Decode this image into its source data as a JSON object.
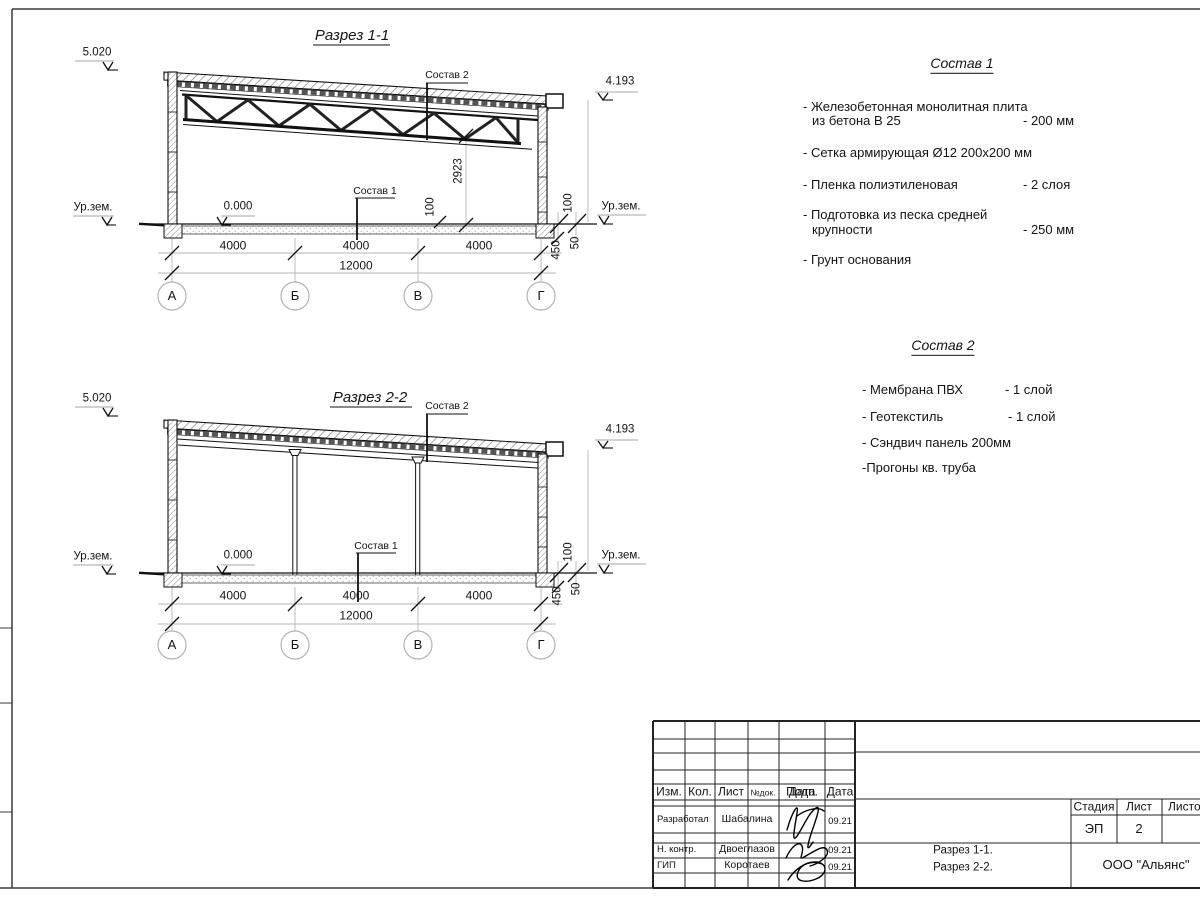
{
  "section1": {
    "title": "Разрез 1-1",
    "elevation_top": "5.020",
    "elevation_roof": "4.193",
    "ground_left": "Ур.зем.",
    "ground_right": "Ур.зем.",
    "floor_level": "0.000",
    "ref_sostav1": "Состав 1",
    "ref_sostav2": "Состав 2",
    "dim_truss_height": "2923",
    "dim_slab": "100",
    "dim_wall": "100",
    "dim_foundation": "450",
    "dim_bed": "50",
    "span_dims": [
      "4000",
      "4000",
      "4000"
    ],
    "total_dim": "12000",
    "axes": [
      "А",
      "Б",
      "В",
      "Г"
    ]
  },
  "section2": {
    "title": "Разрез 2-2",
    "elevation_top": "5.020",
    "elevation_roof": "4.193",
    "ground_left": "Ур.зем.",
    "ground_right": "Ур.зем.",
    "floor_level": "0.000",
    "ref_sostav1": "Состав 1",
    "ref_sostav2": "Состав 2",
    "dim_wall": "100",
    "dim_foundation": "450",
    "dim_bed": "50",
    "span_dims": [
      "4000",
      "4000",
      "4000"
    ],
    "total_dim": "12000",
    "axes": [
      "А",
      "Б",
      "В",
      "Г"
    ]
  },
  "notes1": {
    "heading": "Состав 1",
    "item1_line1": "- Железобетонная  монолитная плита",
    "item1_line2": "из бетона В 25",
    "item1_value": "- 200 мм",
    "item2": "- Сетка армирующая Ø12 200х200 мм",
    "item3": "- Пленка полиэтиленовая",
    "item3_value": "-  2 слоя",
    "item4_line1": "- Подготовка из песка средней",
    "item4_line2": "крупности",
    "item4_value": "- 250 мм",
    "item5": "- Грунт основания"
  },
  "notes2": {
    "heading": "Состав 2",
    "item1": "- Мембрана ПВХ",
    "item1_value": "- 1 слой",
    "item2": "- Геотекстиль",
    "item2_value": "- 1 слой",
    "item3": "- Сэндвич панель 200мм",
    "item4": "-Прогоны кв. труба"
  },
  "titleblock": {
    "col_izm": "Изм.",
    "col_kol": "Кол.",
    "col_list": "Лист",
    "col_ndok": "№док.",
    "col_podp": "Подп.",
    "col_data": "Дата",
    "row1_role": "Разработал",
    "row1_name": "Шабалина",
    "row1_date": "09.21",
    "row2_role": "Н. контр.",
    "row2_name": "Двоеглазов",
    "row2_date": "09.21",
    "row3_role": "ГИП",
    "row3_name": "Коротаев",
    "row3_date": "09.21",
    "stage_label": "Стадия",
    "sheet_label": "Лист",
    "sheets_label": "Листов",
    "stage_value": "ЭП",
    "sheet_value": "2",
    "doc_line1": "Разрез 1-1.",
    "doc_line2": "Разрез 2-2.",
    "company": "ООО \"Альянс\""
  }
}
